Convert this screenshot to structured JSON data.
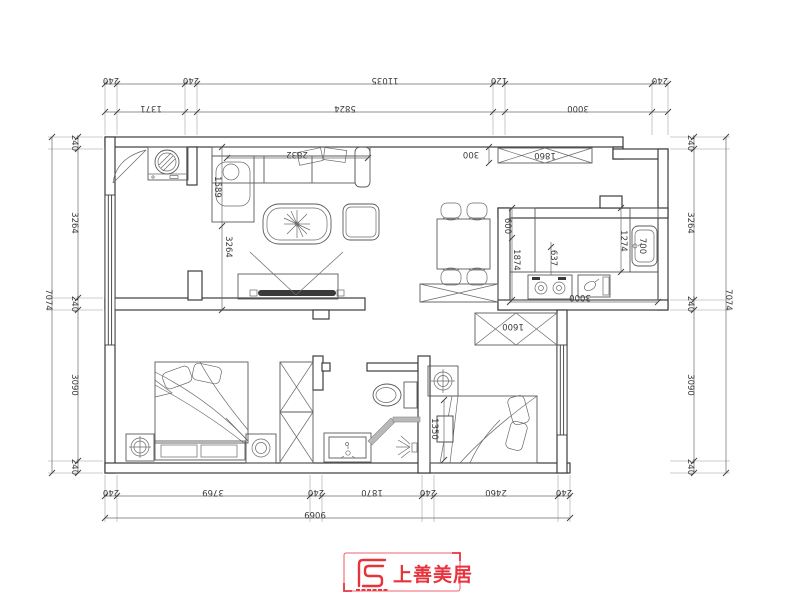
{
  "dims": {
    "top_outer": [
      "240",
      "240",
      "11035",
      "120",
      "240"
    ],
    "top_inner": [
      "1371",
      "5824",
      "3000"
    ],
    "bottom_outer": [
      "240",
      "3769",
      "240",
      "1870",
      "240",
      "2460",
      "240"
    ],
    "bottom_total": "9069",
    "side": [
      "240",
      "3264",
      "240",
      "3090",
      "240"
    ],
    "side_total": "7074",
    "interior": {
      "sofa": "2832",
      "chaise": "1589",
      "living": "3264",
      "entry_gap": "300",
      "shoe_cabinet": "1860",
      "counter_depth": "600",
      "counter_run": "1874",
      "stove": "637",
      "sink_run": "1274",
      "sink": "700",
      "kitchen": "3000",
      "wardrobe": "1600",
      "bed": "1350"
    }
  },
  "logo": {
    "brand": "上善美居",
    "accent": "#e8323c"
  }
}
